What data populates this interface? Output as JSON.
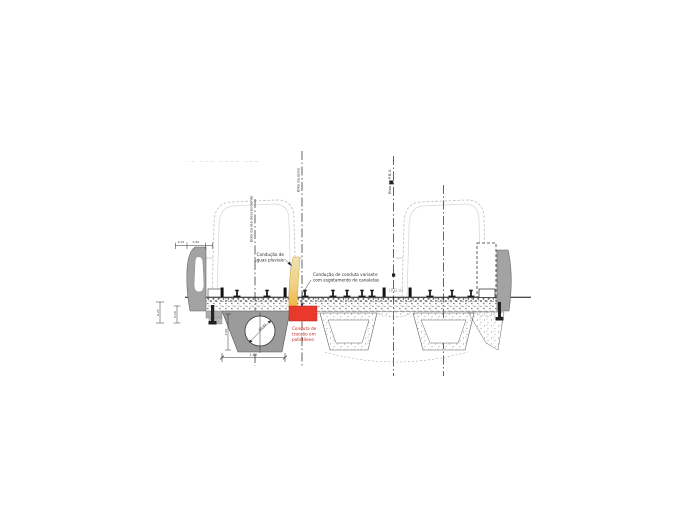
{
  "note_top_left": "– — ——— ———— ———",
  "axes": {
    "left_track_label": "Eixo da via descendente",
    "bridge_axis_label": "Eixo da obra",
    "pbv_axis_label": "Eixo do P.B.V.",
    "pbv_tag": "(P.B.V)"
  },
  "annotations": {
    "drain": {
      "line1": "Condução de",
      "line2": "águas pluviais"
    },
    "conduit": {
      "line1": "Condução de conduta variante",
      "line2": "com esgotamento de canaletas"
    },
    "traction": {
      "line1": "Conduta de",
      "line2": "tracção em",
      "line3": "polietileno"
    }
  },
  "dimensions": {
    "top_a": "0.15",
    "top_b": "0.40",
    "left_a": "0.25",
    "left_b": "0.20",
    "block_height": "0.40",
    "block_width": "1.60",
    "pipe_diameter": "Ø0.60"
  },
  "colors": {
    "highlight_red": "#e9392c",
    "highlight_yellow": "#f0c45c",
    "concrete_gray": "#9b9b9b",
    "line": "#222222"
  }
}
